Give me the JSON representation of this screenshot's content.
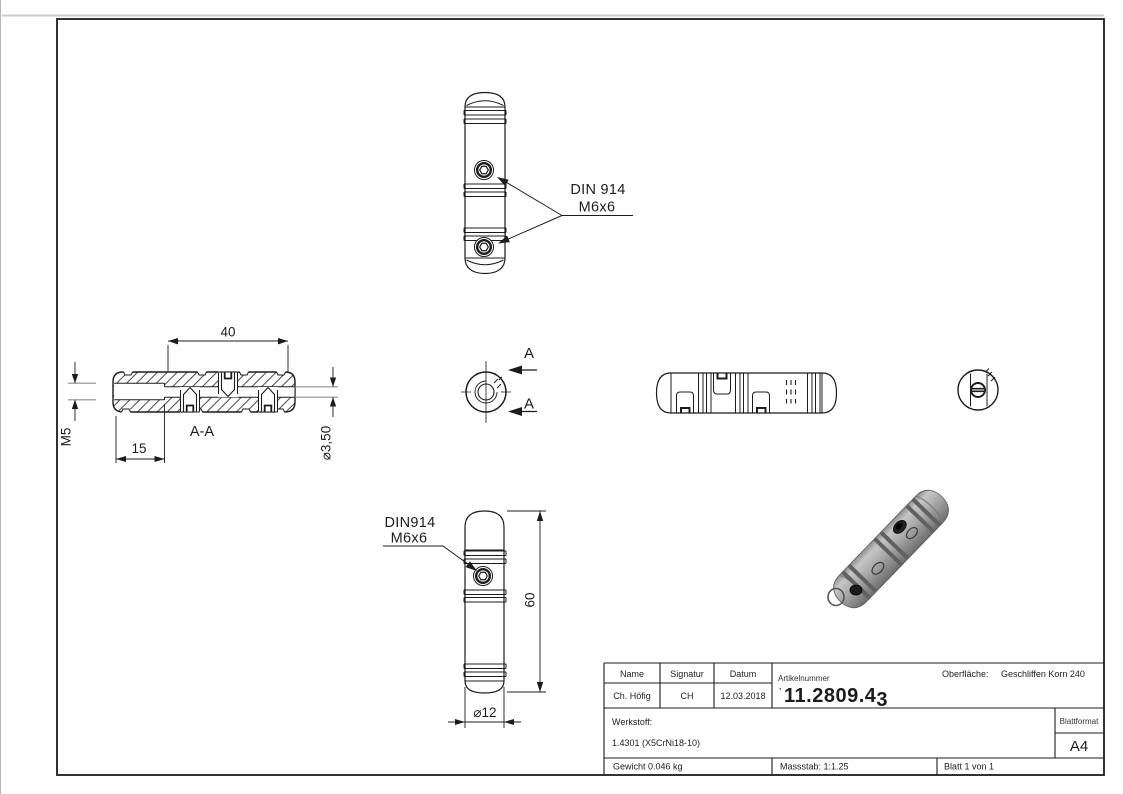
{
  "page": {
    "background": "#ffffff",
    "line_color": "#1c1c1c"
  },
  "callouts": {
    "top_view": {
      "line1": "DIN 914",
      "line2": "M6x6"
    },
    "front_view": {
      "line1": "DIN914",
      "line2": "M6x6"
    }
  },
  "dimensions": {
    "length_40": "40",
    "depth_15": "15",
    "thread_m5": "M5",
    "bore_d350": "⌀3,50",
    "length_60": "60",
    "diameter_d12": "⌀12"
  },
  "section": {
    "label": "A-A",
    "arrow_top": "A",
    "arrow_bottom": "A"
  },
  "title_block": {
    "name_header": "Name",
    "signature_header": "Signatur",
    "date_header": "Datum",
    "name": "Ch. Höfig",
    "signature": "CH",
    "date": "12.03.2018",
    "article_label": "Artikelnummer",
    "article_prefix": "’",
    "article_number_main": "11.2809.4",
    "article_number_last": "3",
    "surface_label": "Oberfläche:",
    "surface_value": "Geschliffen Korn 240",
    "material_label": "Werkstoff:",
    "material_value": "1.4301 (X5CrNi18-10)",
    "weight": "Gewicht 0.046 kg",
    "scale": "Massstab: 1:1.25",
    "sheet": "Blatt 1 von 1",
    "format_label": "Blattformat",
    "format_value": "A4"
  }
}
